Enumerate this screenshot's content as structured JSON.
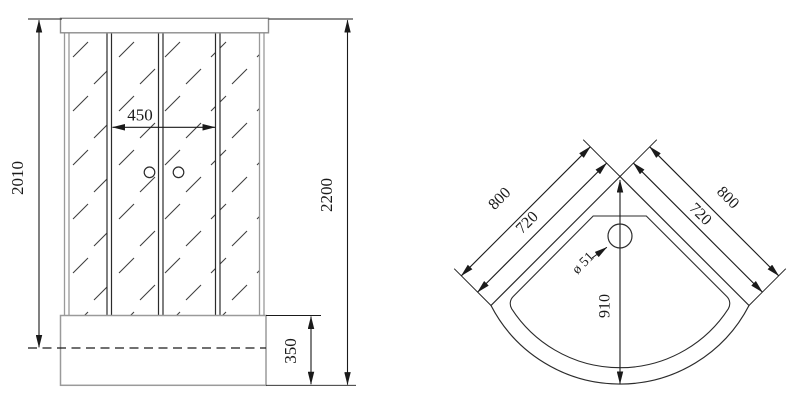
{
  "drawing": {
    "title": "shower-cabin-technical-drawing",
    "front_view": {
      "name": "front-elevation",
      "dim_door_opening_width": "450",
      "dim_glass_section_height": "2010",
      "dim_total_height": "2200",
      "dim_tray_height": "350"
    },
    "top_view": {
      "name": "tray-plan-view",
      "dim_outer_side_left": "800",
      "dim_outer_side_right": "800",
      "dim_inner_side_left": "720",
      "dim_inner_side_right": "720",
      "dim_corner_to_front": "910",
      "dim_drain_diameter": "ø 51"
    },
    "colors": {
      "background": "#ffffff",
      "dimension_lines": "#1a1a1a",
      "structure_gray": "#9a9a9a",
      "frame_black": "#2b2b2b",
      "hatch": "#3d3d3d"
    }
  }
}
